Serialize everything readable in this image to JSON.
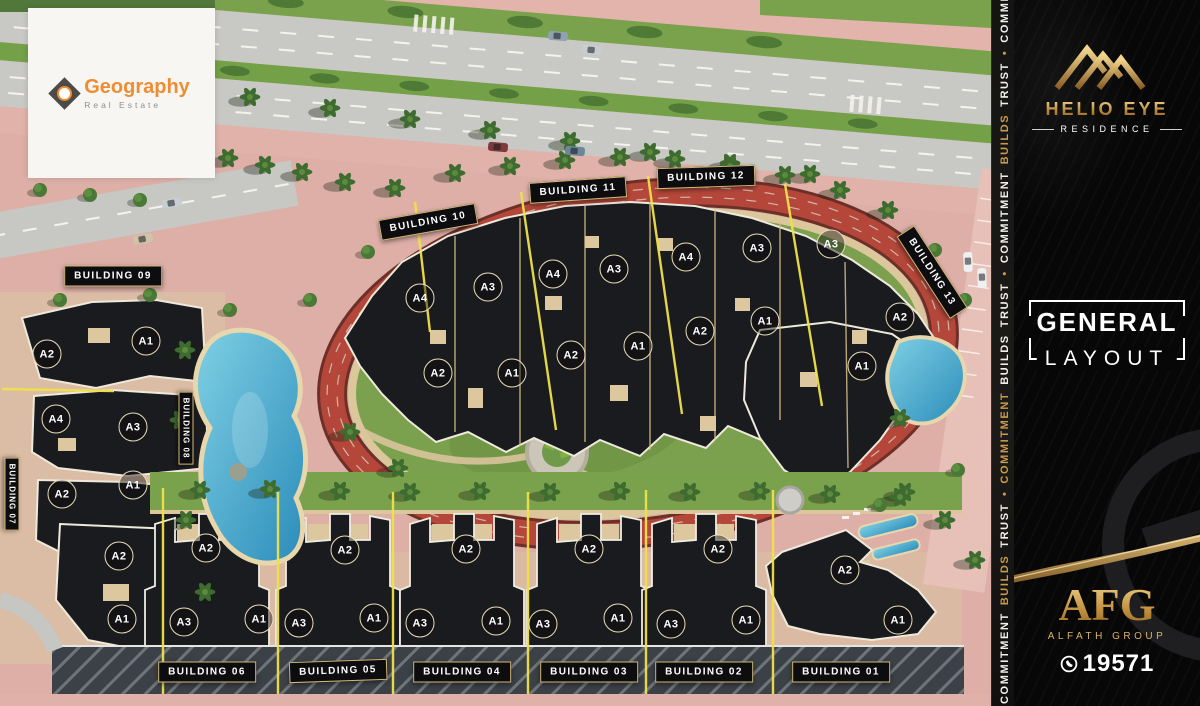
{
  "watermark_card": {
    "brand": "Geography",
    "tagline": "Real Estate"
  },
  "sidebar": {
    "logo": {
      "title": "HELIO EYE",
      "subtitle": "RESIDENCE"
    },
    "section_title": {
      "line1": "GENERAL",
      "line2": "LAYOUT"
    },
    "developer": {
      "abbr": "AFG",
      "name": "ALFATH GROUP",
      "phone": "19571"
    },
    "ribbon": {
      "words": [
        {
          "t": "COMMITMENT",
          "gold": false
        },
        {
          "t": "BUILDS",
          "gold": true
        },
        {
          "t": "TRUST",
          "gold": false
        },
        {
          "t": "•",
          "gold": true
        },
        {
          "t": "COMMITMENT",
          "gold": true
        },
        {
          "t": "BUILDS",
          "gold": false
        },
        {
          "t": "TRUST",
          "gold": false
        },
        {
          "t": "•",
          "gold": true
        },
        {
          "t": "COMMITMENT",
          "gold": false
        },
        {
          "t": "BUILDS",
          "gold": true
        },
        {
          "t": "TRUST",
          "gold": false
        },
        {
          "t": "•",
          "gold": true
        },
        {
          "t": "COMMITMENT",
          "gold": false
        },
        {
          "t": "BUILDS",
          "gold": true
        },
        {
          "t": "TRUST",
          "gold": false
        },
        {
          "t": "•",
          "gold": true
        }
      ]
    }
  },
  "colors": {
    "gold": "#c89a4d",
    "label_border": "#d3b878",
    "brand_orange": "#ee8d33",
    "track_red": "#b4473a",
    "pool_blue": "#45a8cc",
    "lawn_green": "#7ca14e",
    "road_pink": "#ddafa7",
    "asphalt": "#c8c8c4",
    "building_dark": "#1a1b1e",
    "divider_yellow": "#f0e14b",
    "sand": "#dcc79c"
  },
  "map": {
    "building_labels": [
      {
        "id": "01",
        "text": "BUILDING 01",
        "x": 841,
        "y": 672,
        "rot": 0
      },
      {
        "id": "02",
        "text": "BUILDING 02",
        "x": 704,
        "y": 672,
        "rot": 0
      },
      {
        "id": "03",
        "text": "BUILDING 03",
        "x": 589,
        "y": 672,
        "rot": 0
      },
      {
        "id": "04",
        "text": "BUILDING 04",
        "x": 462,
        "y": 672,
        "rot": 0
      },
      {
        "id": "05",
        "text": "BUILDING 05",
        "x": 338,
        "y": 671,
        "rot": -2
      },
      {
        "id": "06",
        "text": "BUILDING 06",
        "x": 207,
        "y": 672,
        "rot": 0
      },
      {
        "id": "07",
        "text": "BUILDING 07",
        "x": 12,
        "y": 494,
        "rot": 90
      },
      {
        "id": "08",
        "text": "BUILDING 08",
        "x": 186,
        "y": 428,
        "rot": 90
      },
      {
        "id": "09",
        "text": "BUILDING 09",
        "x": 113,
        "y": 276,
        "rot": 0
      },
      {
        "id": "10",
        "text": "BUILDING 10",
        "x": 428,
        "y": 222,
        "rot": -10
      },
      {
        "id": "11",
        "text": "BUILDING 11",
        "x": 578,
        "y": 190,
        "rot": -4
      },
      {
        "id": "12",
        "text": "BUILDING 12",
        "x": 706,
        "y": 177,
        "rot": -2
      },
      {
        "id": "13",
        "text": "BUILDING 13",
        "x": 932,
        "y": 272,
        "rot": 57
      }
    ],
    "unit_badges": [
      {
        "t": "A4",
        "x": 420,
        "y": 298
      },
      {
        "t": "A3",
        "x": 488,
        "y": 287
      },
      {
        "t": "A4",
        "x": 553,
        "y": 274
      },
      {
        "t": "A3",
        "x": 614,
        "y": 269
      },
      {
        "t": "A4",
        "x": 686,
        "y": 257
      },
      {
        "t": "A3",
        "x": 757,
        "y": 248
      },
      {
        "t": "A3",
        "x": 831,
        "y": 244
      },
      {
        "t": "A2",
        "x": 438,
        "y": 373
      },
      {
        "t": "A1",
        "x": 512,
        "y": 373
      },
      {
        "t": "A2",
        "x": 571,
        "y": 355
      },
      {
        "t": "A1",
        "x": 638,
        "y": 346
      },
      {
        "t": "A2",
        "x": 700,
        "y": 331
      },
      {
        "t": "A1",
        "x": 765,
        "y": 321
      },
      {
        "t": "A2",
        "x": 900,
        "y": 317
      },
      {
        "t": "A1",
        "x": 862,
        "y": 366
      },
      {
        "t": "A2",
        "x": 47,
        "y": 354
      },
      {
        "t": "A1",
        "x": 146,
        "y": 341
      },
      {
        "t": "A4",
        "x": 56,
        "y": 419
      },
      {
        "t": "A3",
        "x": 133,
        "y": 427
      },
      {
        "t": "A2",
        "x": 62,
        "y": 494
      },
      {
        "t": "A1",
        "x": 133,
        "y": 485
      },
      {
        "t": "A2",
        "x": 119,
        "y": 556
      },
      {
        "t": "A1",
        "x": 122,
        "y": 619
      },
      {
        "t": "A2",
        "x": 206,
        "y": 548
      },
      {
        "t": "A3",
        "x": 184,
        "y": 622
      },
      {
        "t": "A1",
        "x": 259,
        "y": 619
      },
      {
        "t": "A2",
        "x": 345,
        "y": 550
      },
      {
        "t": "A3",
        "x": 299,
        "y": 623
      },
      {
        "t": "A1",
        "x": 374,
        "y": 618
      },
      {
        "t": "A2",
        "x": 466,
        "y": 549
      },
      {
        "t": "A3",
        "x": 420,
        "y": 623
      },
      {
        "t": "A1",
        "x": 496,
        "y": 621
      },
      {
        "t": "A2",
        "x": 589,
        "y": 549
      },
      {
        "t": "A3",
        "x": 543,
        "y": 624
      },
      {
        "t": "A1",
        "x": 618,
        "y": 618
      },
      {
        "t": "A2",
        "x": 718,
        "y": 549
      },
      {
        "t": "A3",
        "x": 671,
        "y": 624
      },
      {
        "t": "A1",
        "x": 746,
        "y": 620
      },
      {
        "t": "A2",
        "x": 845,
        "y": 570
      },
      {
        "t": "A1",
        "x": 898,
        "y": 620
      }
    ]
  }
}
